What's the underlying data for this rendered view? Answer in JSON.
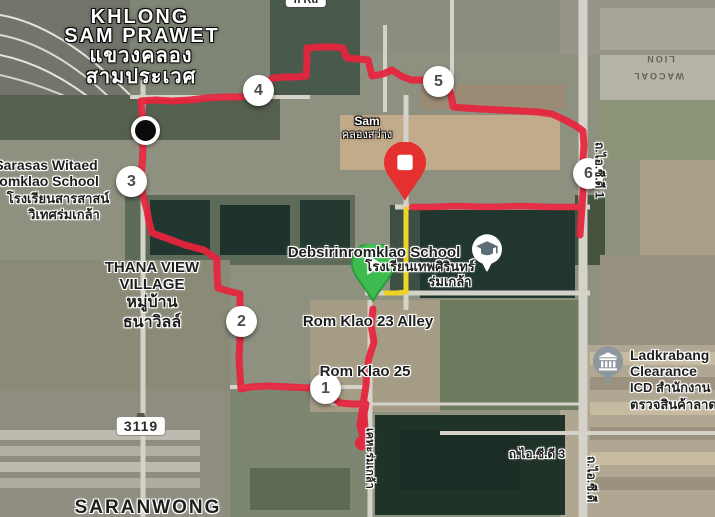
{
  "area_labels": {
    "district_line1": "KHLONG",
    "district_line2": "SAM PRAWET",
    "district_th_line1": "แขวงคลอง",
    "district_th_line2": "สามประเวศ",
    "saranwong": "SARANWONG",
    "thana_view_line1": "THANA VIEW",
    "thana_view_line2": "VILLAGE",
    "thana_view_th_line1": "หมู่บ้าน",
    "thana_view_th_line2": "ธนาวิลล์"
  },
  "pois": {
    "sarasas_line1": "Sarasas Witaed",
    "sarasas_line2": "Romklao School",
    "sarasas_line3": "โรงเรียนสารสาสน์",
    "sarasas_line4": "วิเทศร่มเกล้า",
    "debsirin_line1": "Debsirinromklao School",
    "debsirin_line2": "โรงเรียนเทพศิรินทร์",
    "debsirin_line3": "ร่มเกล้า",
    "ladkrabang_line1": "Ladkrabang",
    "ladkrabang_line2": "Clearance",
    "ladkrabang_line3": "ICD สำนักงาน",
    "ladkrabang_line4": "ตรวจสินค้าลาด",
    "sam_line1": "Sam",
    "sam_line2": "คลองสว่าง"
  },
  "road_labels": {
    "rom_klao_23": "Rom Klao 23 Alley",
    "rom_klao_25": "Rom Klao 25",
    "route_3119": "3119",
    "icd_road_1": "ถ.ไอ.ซี.ดี 1",
    "icd_road_3": "ถ.ไอ.ซี.ดี 3",
    "icd_road_right": "ถ.ไอ.ซี.ดี",
    "keha_romklao": "เคหะร่มเกล้า",
    "top_road": "n Rd"
  },
  "building_labels": {
    "lion": "LION",
    "wacoal": "WACOAL"
  },
  "markers": {
    "km": [
      {
        "label": "1",
        "x": 326,
        "y": 389
      },
      {
        "label": "2",
        "x": 242,
        "y": 322
      },
      {
        "label": "3",
        "x": 132,
        "y": 182
      },
      {
        "label": "4",
        "x": 259,
        "y": 91
      },
      {
        "label": "5",
        "x": 439,
        "y": 82
      },
      {
        "label": "6",
        "x": 589,
        "y": 174
      }
    ],
    "start": {
      "x": 373,
      "y": 307
    },
    "finish": {
      "x": 405,
      "y": 207
    },
    "pause_dot": {
      "x": 142,
      "y": 127
    },
    "school_poi": {
      "x": 487,
      "y": 272
    },
    "icd_poi": {
      "x": 608,
      "y": 384
    }
  },
  "route": {
    "segments": [
      {
        "name": "route-track-main",
        "color": "#e8243e",
        "width": 7,
        "points": [
          [
            373,
            309
          ],
          [
            371,
            325
          ],
          [
            374,
            342
          ],
          [
            369,
            358
          ],
          [
            367,
            372
          ],
          [
            366,
            386
          ],
          [
            364,
            398
          ],
          [
            362,
            412
          ],
          [
            360,
            425
          ],
          [
            363,
            437
          ],
          [
            365,
            444
          ],
          [
            361,
            447
          ],
          [
            363,
            438
          ],
          [
            365,
            428
          ],
          [
            364,
            414
          ],
          [
            366,
            404
          ],
          [
            352,
            404
          ],
          [
            340,
            403
          ],
          [
            322,
            390
          ],
          [
            310,
            388
          ],
          [
            290,
            387
          ],
          [
            268,
            386
          ],
          [
            250,
            387
          ],
          [
            241,
            389
          ],
          [
            240,
            375
          ],
          [
            239,
            358
          ],
          [
            240,
            340
          ],
          [
            241,
            322
          ],
          [
            240,
            305
          ],
          [
            240,
            294
          ],
          [
            228,
            291
          ],
          [
            218,
            288
          ],
          [
            217,
            272
          ],
          [
            217,
            259
          ],
          [
            204,
            250
          ],
          [
            185,
            245
          ],
          [
            166,
            238
          ],
          [
            152,
            233
          ],
          [
            149,
            222
          ],
          [
            147,
            210
          ],
          [
            143,
            196
          ],
          [
            141,
            183
          ],
          [
            142,
            167
          ],
          [
            143,
            150
          ],
          [
            142,
            136
          ],
          [
            142,
            127
          ],
          [
            142,
            113
          ],
          [
            141,
            101
          ],
          [
            155,
            100
          ],
          [
            172,
            101
          ],
          [
            190,
            100
          ],
          [
            207,
            98
          ],
          [
            226,
            97
          ],
          [
            241,
            97
          ],
          [
            255,
            94
          ],
          [
            262,
            91
          ],
          [
            267,
            83
          ],
          [
            273,
            78
          ],
          [
            285,
            77
          ],
          [
            298,
            77
          ],
          [
            306,
            76
          ],
          [
            307,
            62
          ],
          [
            307,
            48
          ],
          [
            320,
            47
          ],
          [
            334,
            47
          ],
          [
            343,
            48
          ],
          [
            345,
            54
          ],
          [
            347,
            58
          ],
          [
            358,
            59
          ],
          [
            368,
            60
          ],
          [
            370,
            68
          ],
          [
            372,
            76
          ],
          [
            383,
            74
          ],
          [
            392,
            70
          ],
          [
            401,
            76
          ],
          [
            411,
            80
          ],
          [
            422,
            80
          ],
          [
            432,
            84
          ],
          [
            443,
            88
          ],
          [
            450,
            91
          ],
          [
            452,
            100
          ],
          [
            453,
            107
          ],
          [
            465,
            108
          ],
          [
            480,
            109
          ],
          [
            500,
            110
          ],
          [
            520,
            111
          ],
          [
            538,
            112
          ],
          [
            552,
            114
          ],
          [
            565,
            120
          ],
          [
            576,
            126
          ],
          [
            583,
            131
          ],
          [
            584,
            145
          ],
          [
            583,
            160
          ],
          [
            584,
            174
          ],
          [
            583,
            190
          ],
          [
            582,
            207
          ],
          [
            581,
            220
          ],
          [
            580,
            235
          ]
        ]
      },
      {
        "name": "route-track-finish-leg",
        "color": "#e8243e",
        "width": 6.5,
        "points": [
          [
            582,
            207
          ],
          [
            552,
            207
          ],
          [
            520,
            206
          ],
          [
            488,
            207
          ],
          [
            456,
            206
          ],
          [
            430,
            207
          ],
          [
            412,
            207
          ]
        ]
      },
      {
        "name": "route-connector-yellow",
        "color": "#f2d41c",
        "width": 5,
        "points": [
          [
            406,
            209
          ],
          [
            406,
            232
          ],
          [
            406,
            256
          ],
          [
            406,
            278
          ],
          [
            406,
            292
          ],
          [
            396,
            293
          ],
          [
            386,
            293
          ]
        ]
      }
    ],
    "dots": [
      {
        "name": "route-turnaround-blob",
        "color": "#e8243e",
        "x": 362,
        "y": 443,
        "r": 7
      }
    ]
  }
}
